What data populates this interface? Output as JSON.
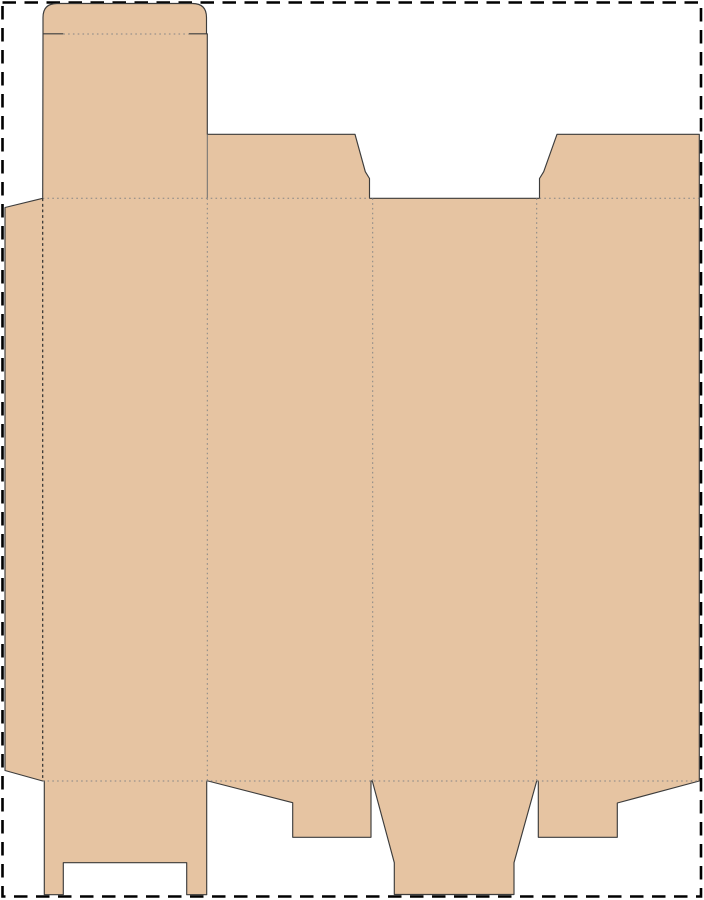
{
  "title": "Folding carton dieline template",
  "canvas": {
    "width": 704,
    "height": 900
  },
  "colors": {
    "page_background": "#ffffff",
    "board_fill": "#e6c4a2",
    "cut_outline": "#3c3c3c",
    "separator_cut": "#6f6f6f",
    "fold_crease": "#858585",
    "glue_fold": "#2f2f2f",
    "page_border": "#000000"
  },
  "page_border": {
    "x": 2.5,
    "y": 2.5,
    "width": 698.5,
    "height": 894,
    "dash": "13.5 8.5"
  },
  "dieline": {
    "crease_dash": "1.6 3.2",
    "glue_dash": "2.8 2.8",
    "blank_path": "M 43 33.8 L 43 17.5 Q 43 3.5 57 3.5 L 192.5 3.5 Q 206.5 3.5 206.5 17.5 L 206.5 33.8 L 207.3 33.8 L 207.3 134.3 L 355 134.3 L 365.3 171.7 L 369.5 178.5 L 369.5 198.3 L 539.5 198.3 L 539.5 178.5 L 543.7 171.7 L 557 134.3 L 699.3 134.3 L 699.3 781 L 617.3 803 L 617.3 837.3 L 538.3 837.3 L 538.3 781 L 536.7 781 L 514 862.7 L 514 894.5 L 394.3 894.5 L 394.3 862.7 L 372.3 781 L 371 781 L 371 837.3 L 292.7 837.3 L 292.7 802.7 L 208 781 L 206.7 781 L 206.7 894.7 L 186.7 894.7 L 186.7 862.7 L 63.3 862.7 L 63.3 894.7 L 44.3 894.7 L 44.3 781 L 42.7 781 L 5 770.5 L 5 207.5 L 42.7 198.3 Z",
    "lines": [
      {
        "name": "tuck-shoulder-left-cut",
        "d": "M 43 33.8 L 63.3 33.8"
      },
      {
        "name": "tuck-shoulder-right-cut",
        "d": "M 189 33.8 L 206.5 33.8"
      },
      {
        "name": "tuck-flap-fold",
        "d": "M 63.3 34 L 189 34"
      },
      {
        "name": "lid-dust-flap-separator-cut",
        "d": "M 207.3 134.3 L 207.3 198.3"
      },
      {
        "name": "top-fold-left",
        "d": "M 42.7 198.3 L 369.5 198.3"
      },
      {
        "name": "top-fold-right",
        "d": "M 539.5 198.3 L 699.3 198.3"
      },
      {
        "name": "bottom-fold",
        "d": "M 42.7 781 L 699.3 781"
      },
      {
        "name": "glue-flap-fold",
        "d": "M 42.7 198.3 L 42.7 781"
      },
      {
        "name": "panel-fold-1-2",
        "d": "M 207.3 198.3 L 207.3 781"
      },
      {
        "name": "panel-fold-2-3",
        "d": "M 372.7 198.3 L 372.7 781"
      },
      {
        "name": "panel-fold-3-4",
        "d": "M 536.7 198.3 L 536.7 781"
      }
    ],
    "panels": [
      "glue-flap",
      "panel-1-with-tuck-lid-and-notched-bottom-flap",
      "panel-2-with-top-dust-flap-and-angled-bottom-flap",
      "panel-3-with-tapered-bottom-tuck",
      "panel-4-with-top-dust-flap-and-angled-bottom-flap"
    ]
  }
}
